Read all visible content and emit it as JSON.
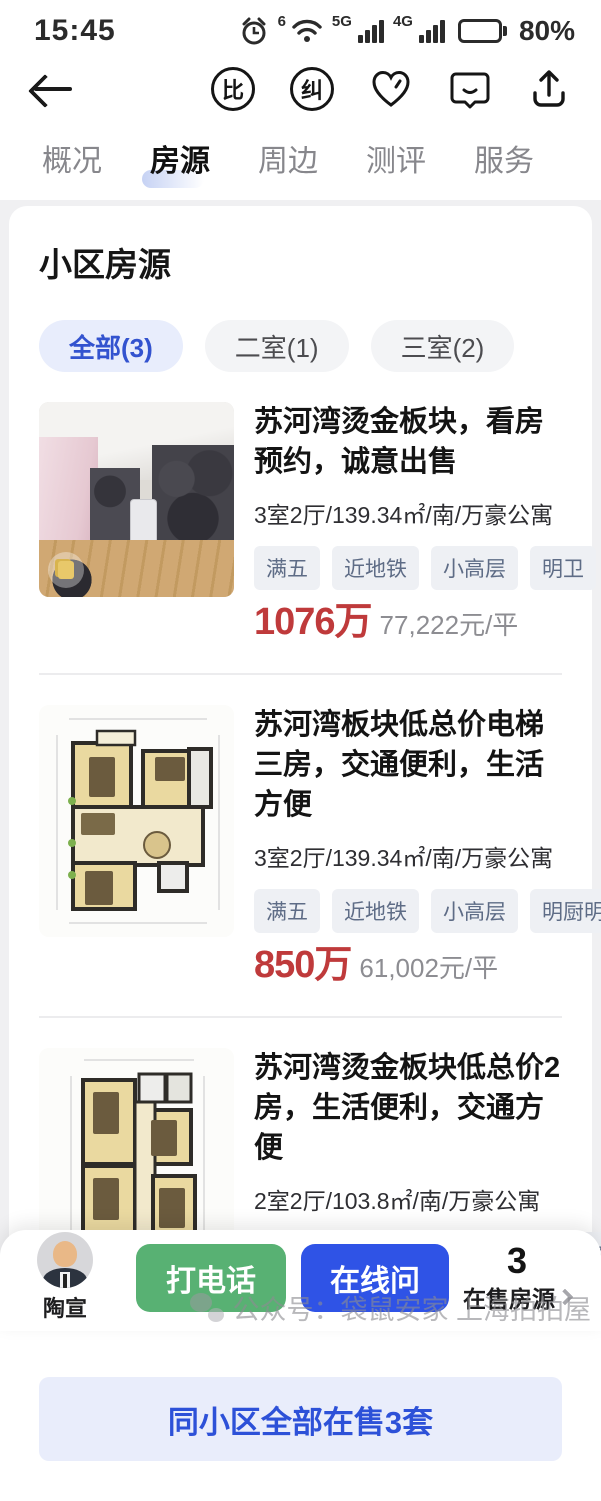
{
  "status_bar": {
    "time": "15:45",
    "wifi_gen": "6",
    "net_5g": "5G",
    "net_4g": "4G",
    "battery": "80%"
  },
  "header": {
    "compare_badge": "比",
    "correction_badge": "纠"
  },
  "tabs": [
    {
      "label": "概况",
      "active": false
    },
    {
      "label": "房源",
      "active": true
    },
    {
      "label": "周边",
      "active": false
    },
    {
      "label": "测评",
      "active": false
    },
    {
      "label": "服务",
      "active": false
    }
  ],
  "section": {
    "title": "小区房源"
  },
  "filters": [
    {
      "label": "全部(3)",
      "active": true
    },
    {
      "label": "二室(1)",
      "active": false
    },
    {
      "label": "三室(2)",
      "active": false
    }
  ],
  "listings": [
    {
      "title": "苏河湾烫金板块，看房预约，诚意出售",
      "specs": "3室2厅/139.34㎡/南/万豪公寓",
      "tags": [
        "满五",
        "近地铁",
        "小高层",
        "明卫"
      ],
      "price": "1076万",
      "unit_price": "77,222元/平",
      "image_type": "photo"
    },
    {
      "title": "苏河湾板块低总价电梯三房，交通便利，生活方便",
      "specs": "3室2厅/139.34㎡/南/万豪公寓",
      "tags": [
        "满五",
        "近地铁",
        "小高层",
        "明厨明卫"
      ],
      "price": "850万",
      "unit_price": "61,002元/平",
      "image_type": "floor-plan"
    },
    {
      "title": "苏河湾烫金板块低总价2房，生活便利，交通方便",
      "specs": "2室2厅/103.8㎡/南/万豪公寓",
      "tags": [
        "满五",
        "近地铁",
        "小高层",
        "全明格局"
      ],
      "price": "698万",
      "unit_price": "67,245元/平",
      "image_type": "floor-plan"
    }
  ],
  "cta": {
    "label": "同小区全部在售3套"
  },
  "bottom_bar": {
    "agent_name": "陶宣",
    "call_button": "打电话",
    "chat_button": "在线问",
    "count": "3",
    "count_label": "在售房源"
  },
  "watermark": {
    "text": "公众号：袋鼠安家 上海拍拍屋"
  },
  "colors": {
    "price_red": "#bf3a3b",
    "accent_blue": "#2f53e6",
    "call_green": "#58b173",
    "chip_active_bg": "#e8edfc",
    "tag_bg": "#eef0f4"
  }
}
